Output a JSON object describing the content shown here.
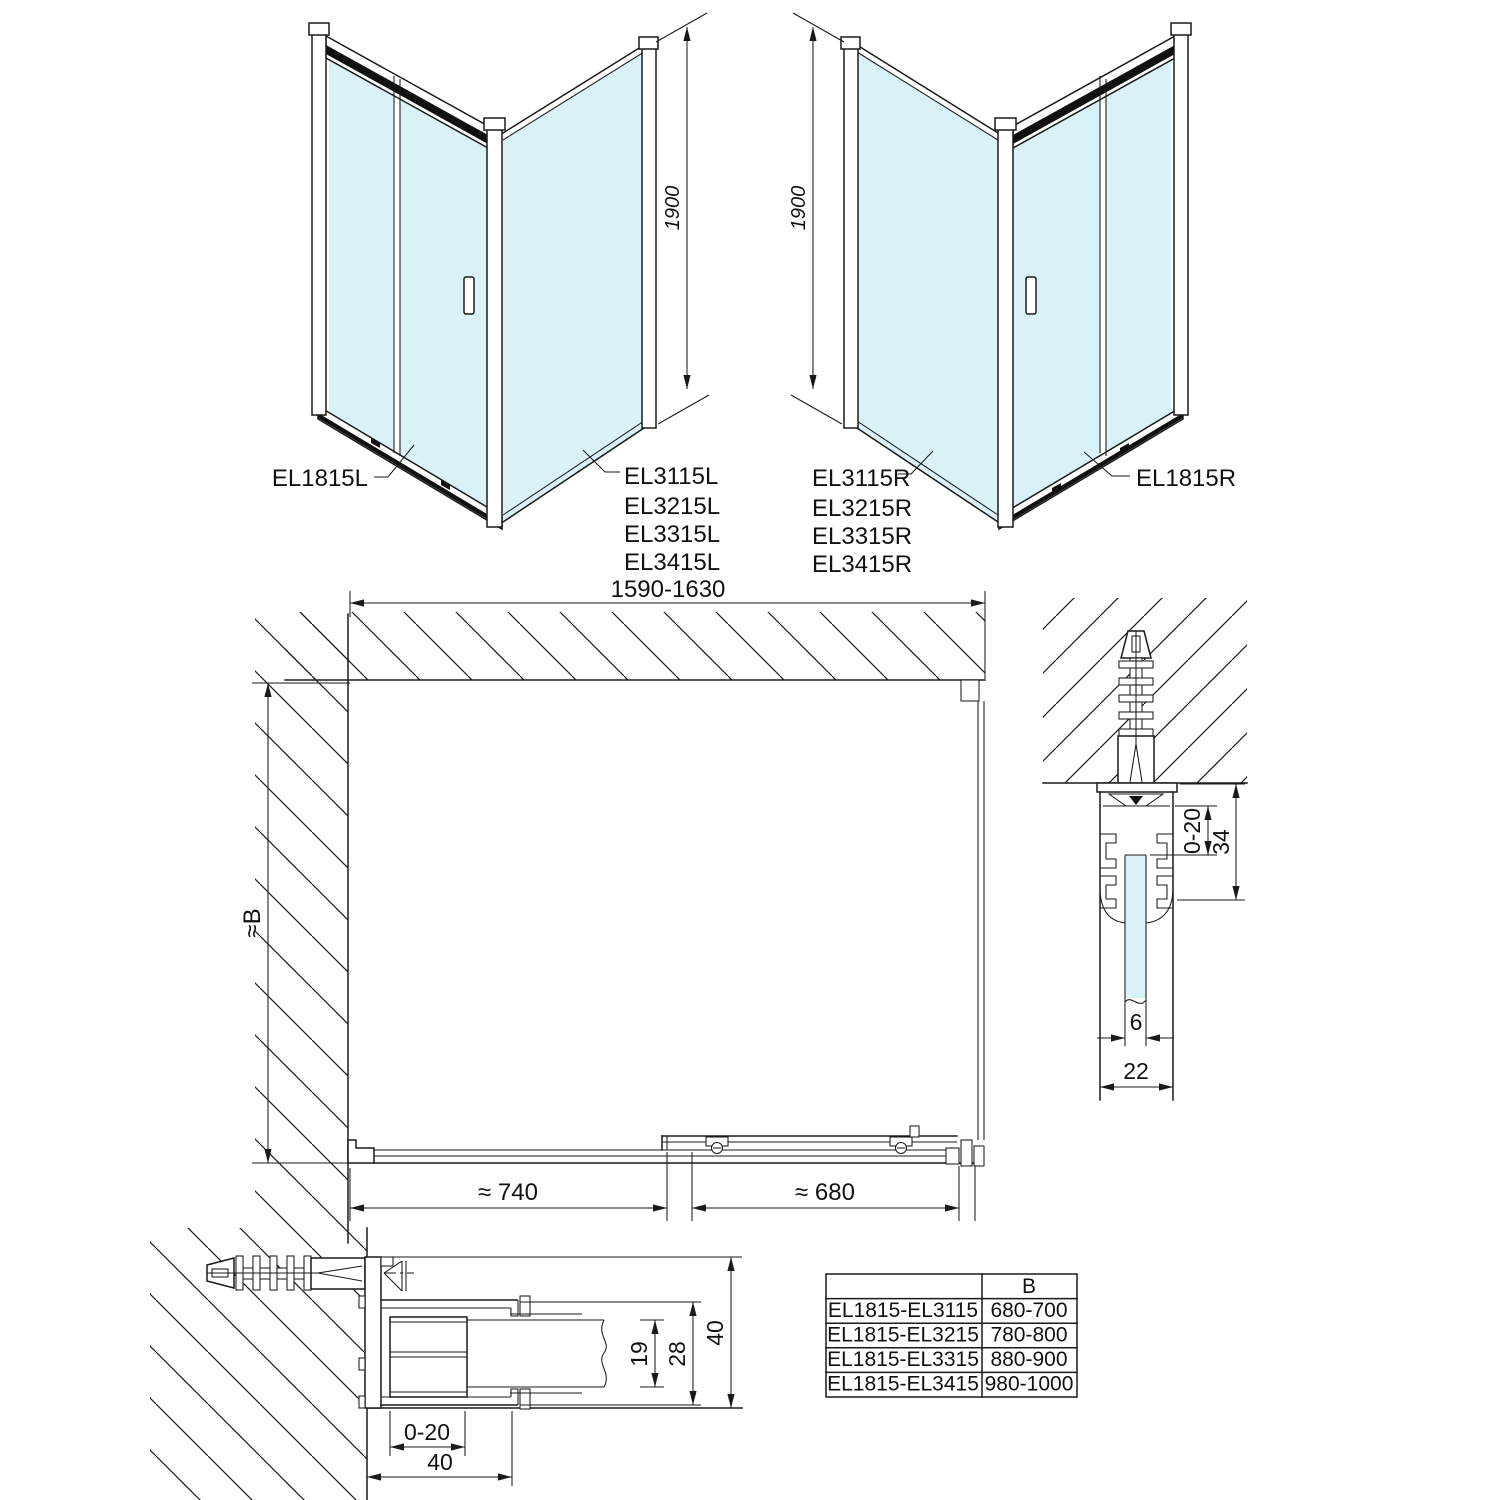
{
  "colors": {
    "line": "#1a1a1a",
    "glass_fill": "#d9f2f8",
    "rail_fill": "#111111",
    "background": "#ffffff"
  },
  "left_view": {
    "door_label": "EL1815L",
    "side_labels": [
      "EL3115L",
      "EL3215L",
      "EL3315L",
      "EL3415L"
    ],
    "height_dim": "1900"
  },
  "right_view": {
    "door_label": "EL1815R",
    "side_labels": [
      "EL3115R",
      "EL3215R",
      "EL3315R",
      "EL3415R"
    ],
    "height_dim": "1900"
  },
  "plan_view": {
    "width_dim": "1590-1630",
    "depth_dim": "≈B",
    "fixed_section_dim": "≈ 740",
    "door_section_dim": "≈ 680"
  },
  "wall_profile_section": {
    "adjust_dim": "0-20",
    "depth_dim": "34",
    "glass_dim": "6",
    "width_dim": "22"
  },
  "door_profile_section": {
    "glass_dim": "19",
    "inner_dim": "28",
    "height_dim": "40",
    "adjust_dim": "0-20",
    "width_dim": "40"
  },
  "size_table": {
    "col_header": "B",
    "rows": [
      {
        "models": "EL1815-EL3115",
        "b": "680-700"
      },
      {
        "models": "EL1815-EL3215",
        "b": "780-800"
      },
      {
        "models": "EL1815-EL3315",
        "b": "880-900"
      },
      {
        "models": "EL1815-EL3415",
        "b": "980-1000"
      }
    ]
  }
}
